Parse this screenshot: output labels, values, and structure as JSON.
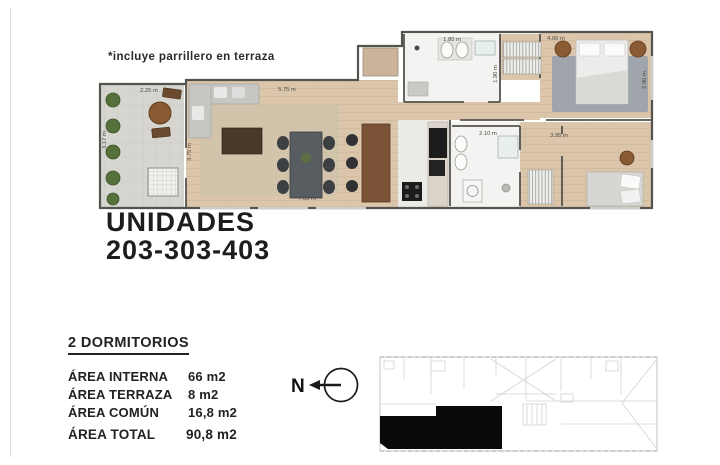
{
  "note": "*incluye parrillero en terraza",
  "title": {
    "line1": "UNIDADES",
    "line2": "203-303-403"
  },
  "summary": {
    "heading": "2 DORMITORIOS",
    "rows": [
      {
        "label": "ÁREA INTERNA",
        "value": "66 m2"
      },
      {
        "label": "ÁREA TERRAZA",
        "value": "8 m2"
      },
      {
        "label": "ÁREA COMÚN",
        "value": "16,8 m2"
      }
    ],
    "total_label": "ÁREA TOTAL",
    "total_value": "90,8 m2"
  },
  "compass": {
    "label": "N"
  },
  "plan": {
    "dimensions": {
      "terrace_width": "2.25 m",
      "terrace_height": "3.17 m",
      "living_width": "5.75 m",
      "living_height": "3.75 m",
      "living_length": "7.85 m",
      "bath1_width": "1.80 m",
      "bath1_height": "1.90 m",
      "bedroom1_width": "4.60 m",
      "bedroom1_height": "2.90 m",
      "bath2_width": "2.10 m",
      "bedroom2_width": "3.95 m"
    }
  },
  "colors": {
    "wall": "#55534e",
    "wood_floor": "#dcc6ab",
    "terrace_floor": "#d6d5d0",
    "bath_floor": "#f4f3f1",
    "unit_highlight": "#0a0a0a",
    "plant_green": "#55703a"
  }
}
